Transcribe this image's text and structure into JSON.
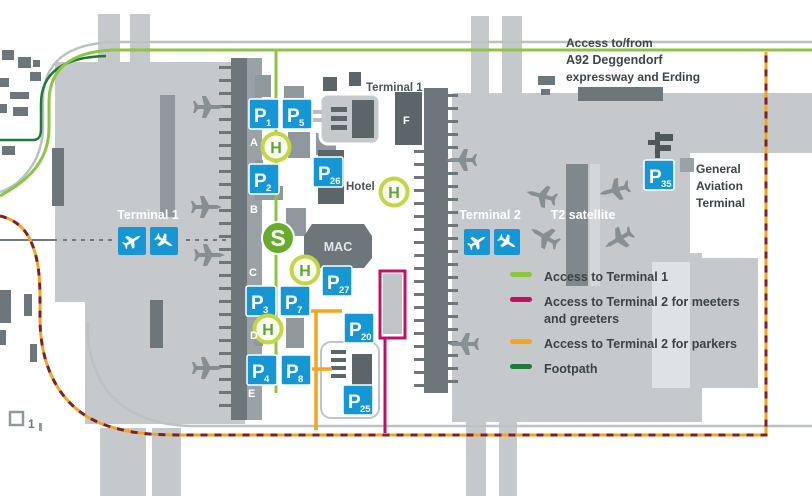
{
  "colors": {
    "parking_blue": "#1697d3",
    "access_t1_green": "#8bc541",
    "footpath_green": "#1d7a38",
    "meeters_magenta": "#c21065",
    "parkers_orange": "#f6a41f",
    "access_road_red": "#7d2128",
    "sbahn_green": "#67ad2b",
    "bus_stop_ring": "#c3d645",
    "bus_stop_letter": "#5ea33c",
    "building_light": "#c5c9cc",
    "building_medium": "#8f989c",
    "building_dark": "#6d777b"
  },
  "top_note": {
    "line1": "Access to/from",
    "line2": "A92 Deggendorf",
    "line3": "expressway and Erding"
  },
  "labels": {
    "terminal1": "Terminal 1",
    "terminal2": "Terminal 2",
    "t2_satellite": "T2 satellite",
    "terminal1_module_f": "Terminal 1",
    "hotel": "Hotel",
    "mac": "MAC",
    "ga_line1": "General",
    "ga_line2": "Aviation",
    "ga_line3": "Terminal",
    "marker_1": "1"
  },
  "legend": {
    "items": [
      {
        "color": "#8bc541",
        "lines": [
          "Access to Terminal 1"
        ]
      },
      {
        "color": "#c21065",
        "lines": [
          "Access to Terminal 2 for meeters",
          "and greeters"
        ]
      },
      {
        "color": "#f6a41f",
        "lines": [
          "Access to Terminal 2 for parkers"
        ]
      },
      {
        "color": "#1d7a38",
        "lines": [
          "Footpath"
        ]
      }
    ]
  },
  "parking_signs": {
    "symbol": "P",
    "items": [
      {
        "num": "1",
        "x": 249,
        "y": 99
      },
      {
        "num": "5",
        "x": 282,
        "y": 99
      },
      {
        "num": "2",
        "x": 249,
        "y": 164
      },
      {
        "num": "26",
        "x": 313,
        "y": 157
      },
      {
        "num": "3",
        "x": 246,
        "y": 286
      },
      {
        "num": "7",
        "x": 280,
        "y": 286
      },
      {
        "num": "27",
        "x": 322,
        "y": 266
      },
      {
        "num": "20",
        "x": 344,
        "y": 313
      },
      {
        "num": "4",
        "x": 247,
        "y": 355
      },
      {
        "num": "8",
        "x": 281,
        "y": 355
      },
      {
        "num": "25",
        "x": 343,
        "y": 385
      },
      {
        "num": "35",
        "x": 644,
        "y": 160
      }
    ]
  },
  "transit": {
    "sbahn": {
      "label": "S",
      "x": 278,
      "y": 238
    },
    "bus_stop_label": "H",
    "bus_stops": [
      {
        "x": 276,
        "y": 147
      },
      {
        "x": 394,
        "y": 192
      },
      {
        "x": 305,
        "y": 270
      },
      {
        "x": 268,
        "y": 329
      }
    ]
  },
  "gate_letters": [
    {
      "ch": "A",
      "x": 250,
      "y": 146
    },
    {
      "ch": "B",
      "x": 250,
      "y": 213
    },
    {
      "ch": "C",
      "x": 249,
      "y": 276
    },
    {
      "ch": "D",
      "x": 250,
      "y": 339
    },
    {
      "ch": "E",
      "x": 248,
      "y": 397
    },
    {
      "ch": "F",
      "x": 403,
      "y": 124
    },
    {
      "ch": "G",
      "x": 406,
      "y": 227
    },
    {
      "ch": "H",
      "x": 407,
      "y": 256
    }
  ],
  "info_signs": [
    {
      "icon": "departures",
      "x": 118,
      "y": 227,
      "size": 28
    },
    {
      "icon": "arrivals",
      "x": 150,
      "y": 227,
      "size": 28
    },
    {
      "icon": "departures",
      "x": 464,
      "y": 229,
      "size": 26
    },
    {
      "icon": "arrivals",
      "x": 494,
      "y": 229,
      "size": 26
    }
  ],
  "planes": [
    {
      "x": 208,
      "y": 107,
      "rot": 0
    },
    {
      "x": 206,
      "y": 207,
      "rot": 0
    },
    {
      "x": 209,
      "y": 255,
      "rot": 0
    },
    {
      "x": 207,
      "y": 368,
      "rot": 0
    },
    {
      "x": 462,
      "y": 160,
      "rot": 180
    },
    {
      "x": 542,
      "y": 196,
      "rot": 195
    },
    {
      "x": 615,
      "y": 190,
      "rot": 165
    },
    {
      "x": 545,
      "y": 237,
      "rot": 210
    },
    {
      "x": 619,
      "y": 239,
      "rot": 150
    },
    {
      "x": 464,
      "y": 344,
      "rot": 180
    }
  ]
}
